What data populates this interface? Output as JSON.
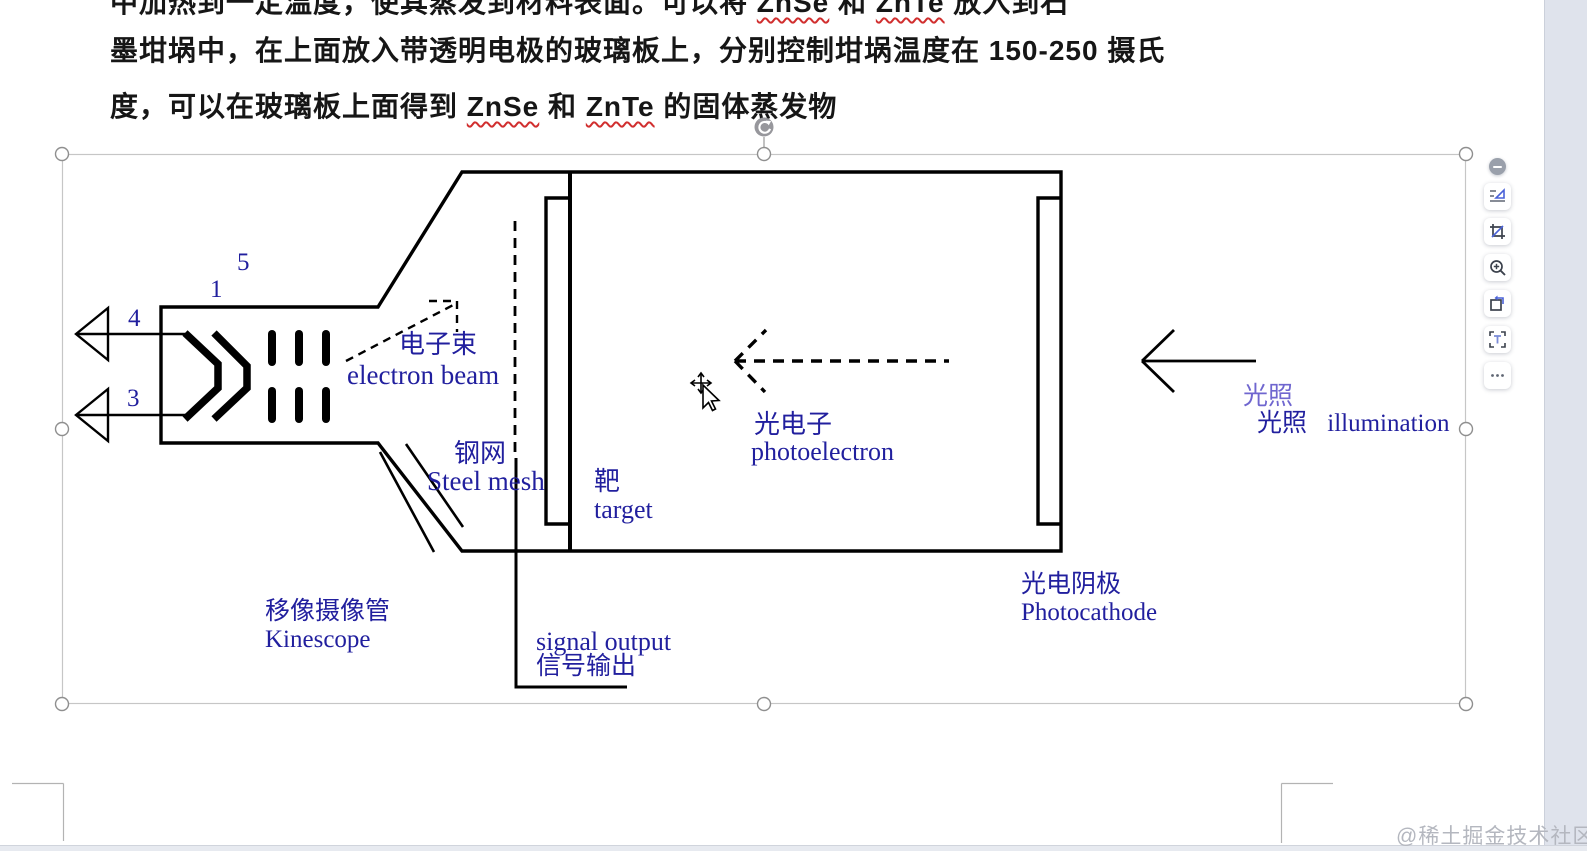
{
  "document": {
    "line1_parts": [
      "中加热到一定温度，使其蒸发到材料表面。可以将 ",
      "ZnSe",
      " 和 ",
      "ZnTe",
      " 放入到石"
    ],
    "line2": "墨坩埚中，在上面放入带透明电极的玻璃板上，分别控制坩埚温度在 150-250 摄氏",
    "line3_parts": [
      "度，可以在玻璃板上面得到 ",
      "ZnSe",
      " 和 ",
      "ZnTe",
      " 的固体蒸发物"
    ]
  },
  "diagram": {
    "numbers": {
      "n5": "5",
      "n1": "1",
      "n4": "4",
      "n3": "3"
    },
    "labels": {
      "electron_beam_cn": "电子束",
      "electron_beam_en": "electron beam",
      "steel_mesh_cn": "钢网",
      "steel_mesh_en": "Steel mesh",
      "target_cn": "靶",
      "target_en": "target",
      "photoelectron_cn": "光电子",
      "photoelectron_en": "photoelectron",
      "signal_output_en": "signal output",
      "signal_output_cn": "信号输出",
      "kinescope_cn": "移像摄像管",
      "kinescope_en": "Kinescope",
      "photocathode_cn": "光电阴极",
      "photocathode_en": "Photocathode",
      "illumination_cn_upper": "光照",
      "illumination_cn_lower": "光照",
      "illumination_en": "illumination"
    },
    "colors": {
      "label_blue": "#211f9e",
      "line_black": "#000000",
      "illum_light_purple": "#6f66cf"
    }
  },
  "toolbar": {
    "buttons": [
      "collapse",
      "wrap-position",
      "crop",
      "zoom-in",
      "rotate",
      "select-text",
      "more"
    ]
  },
  "watermark": "@稀土掘金技术社区"
}
